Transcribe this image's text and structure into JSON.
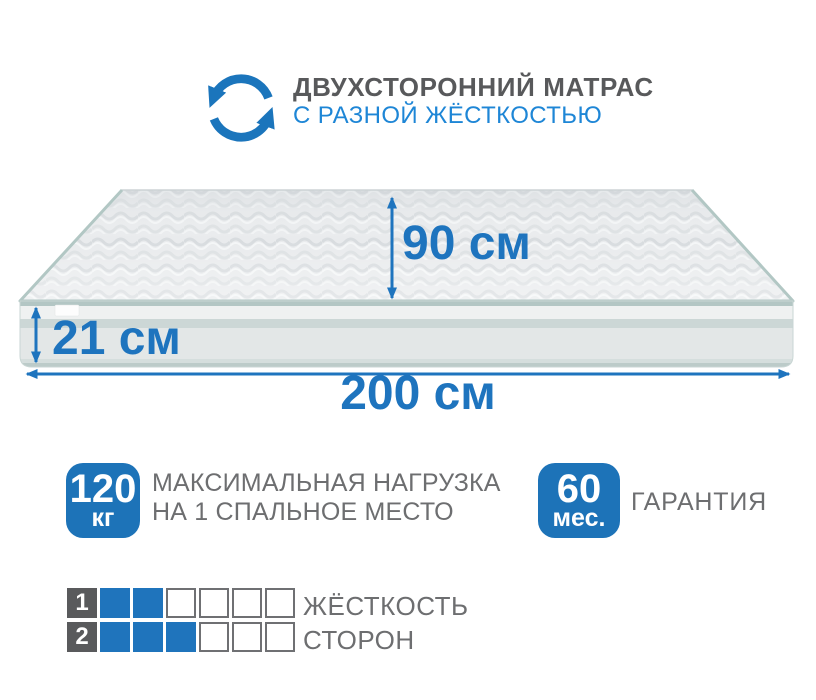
{
  "header": {
    "title": "ДВУХСТОРОННИЙ МАТРАС",
    "subtitle": "С РАЗНОЙ ЖЁСТКОСТЬЮ",
    "icon": "rotate-arrows-icon"
  },
  "dimensions": {
    "depth": "90 см",
    "height": "21 см",
    "length": "200 см"
  },
  "badges": {
    "load": {
      "value": "120",
      "unit": "кг",
      "line1": "МАКСИМАЛЬНАЯ НАГРУЗКА",
      "line2": "НА 1 СПАЛЬНОЕ МЕСТО"
    },
    "warranty": {
      "value": "60",
      "unit": "мес.",
      "label": "ГАРАНТИЯ"
    }
  },
  "firmness": {
    "label_line1": "ЖЁСТКОСТЬ",
    "label_line2": "СТОРОН",
    "scale_max": 6,
    "rows": [
      {
        "side": "1",
        "filled": 2
      },
      {
        "side": "2",
        "filled": 3
      }
    ]
  },
  "colors": {
    "accent_blue": "#1e74be",
    "badge_blue": "#1d73b8",
    "subtitle_blue": "#1e86d6",
    "title_gray": "#58595b",
    "text_gray": "#6d6e70",
    "square_gray": "#595a5c"
  }
}
